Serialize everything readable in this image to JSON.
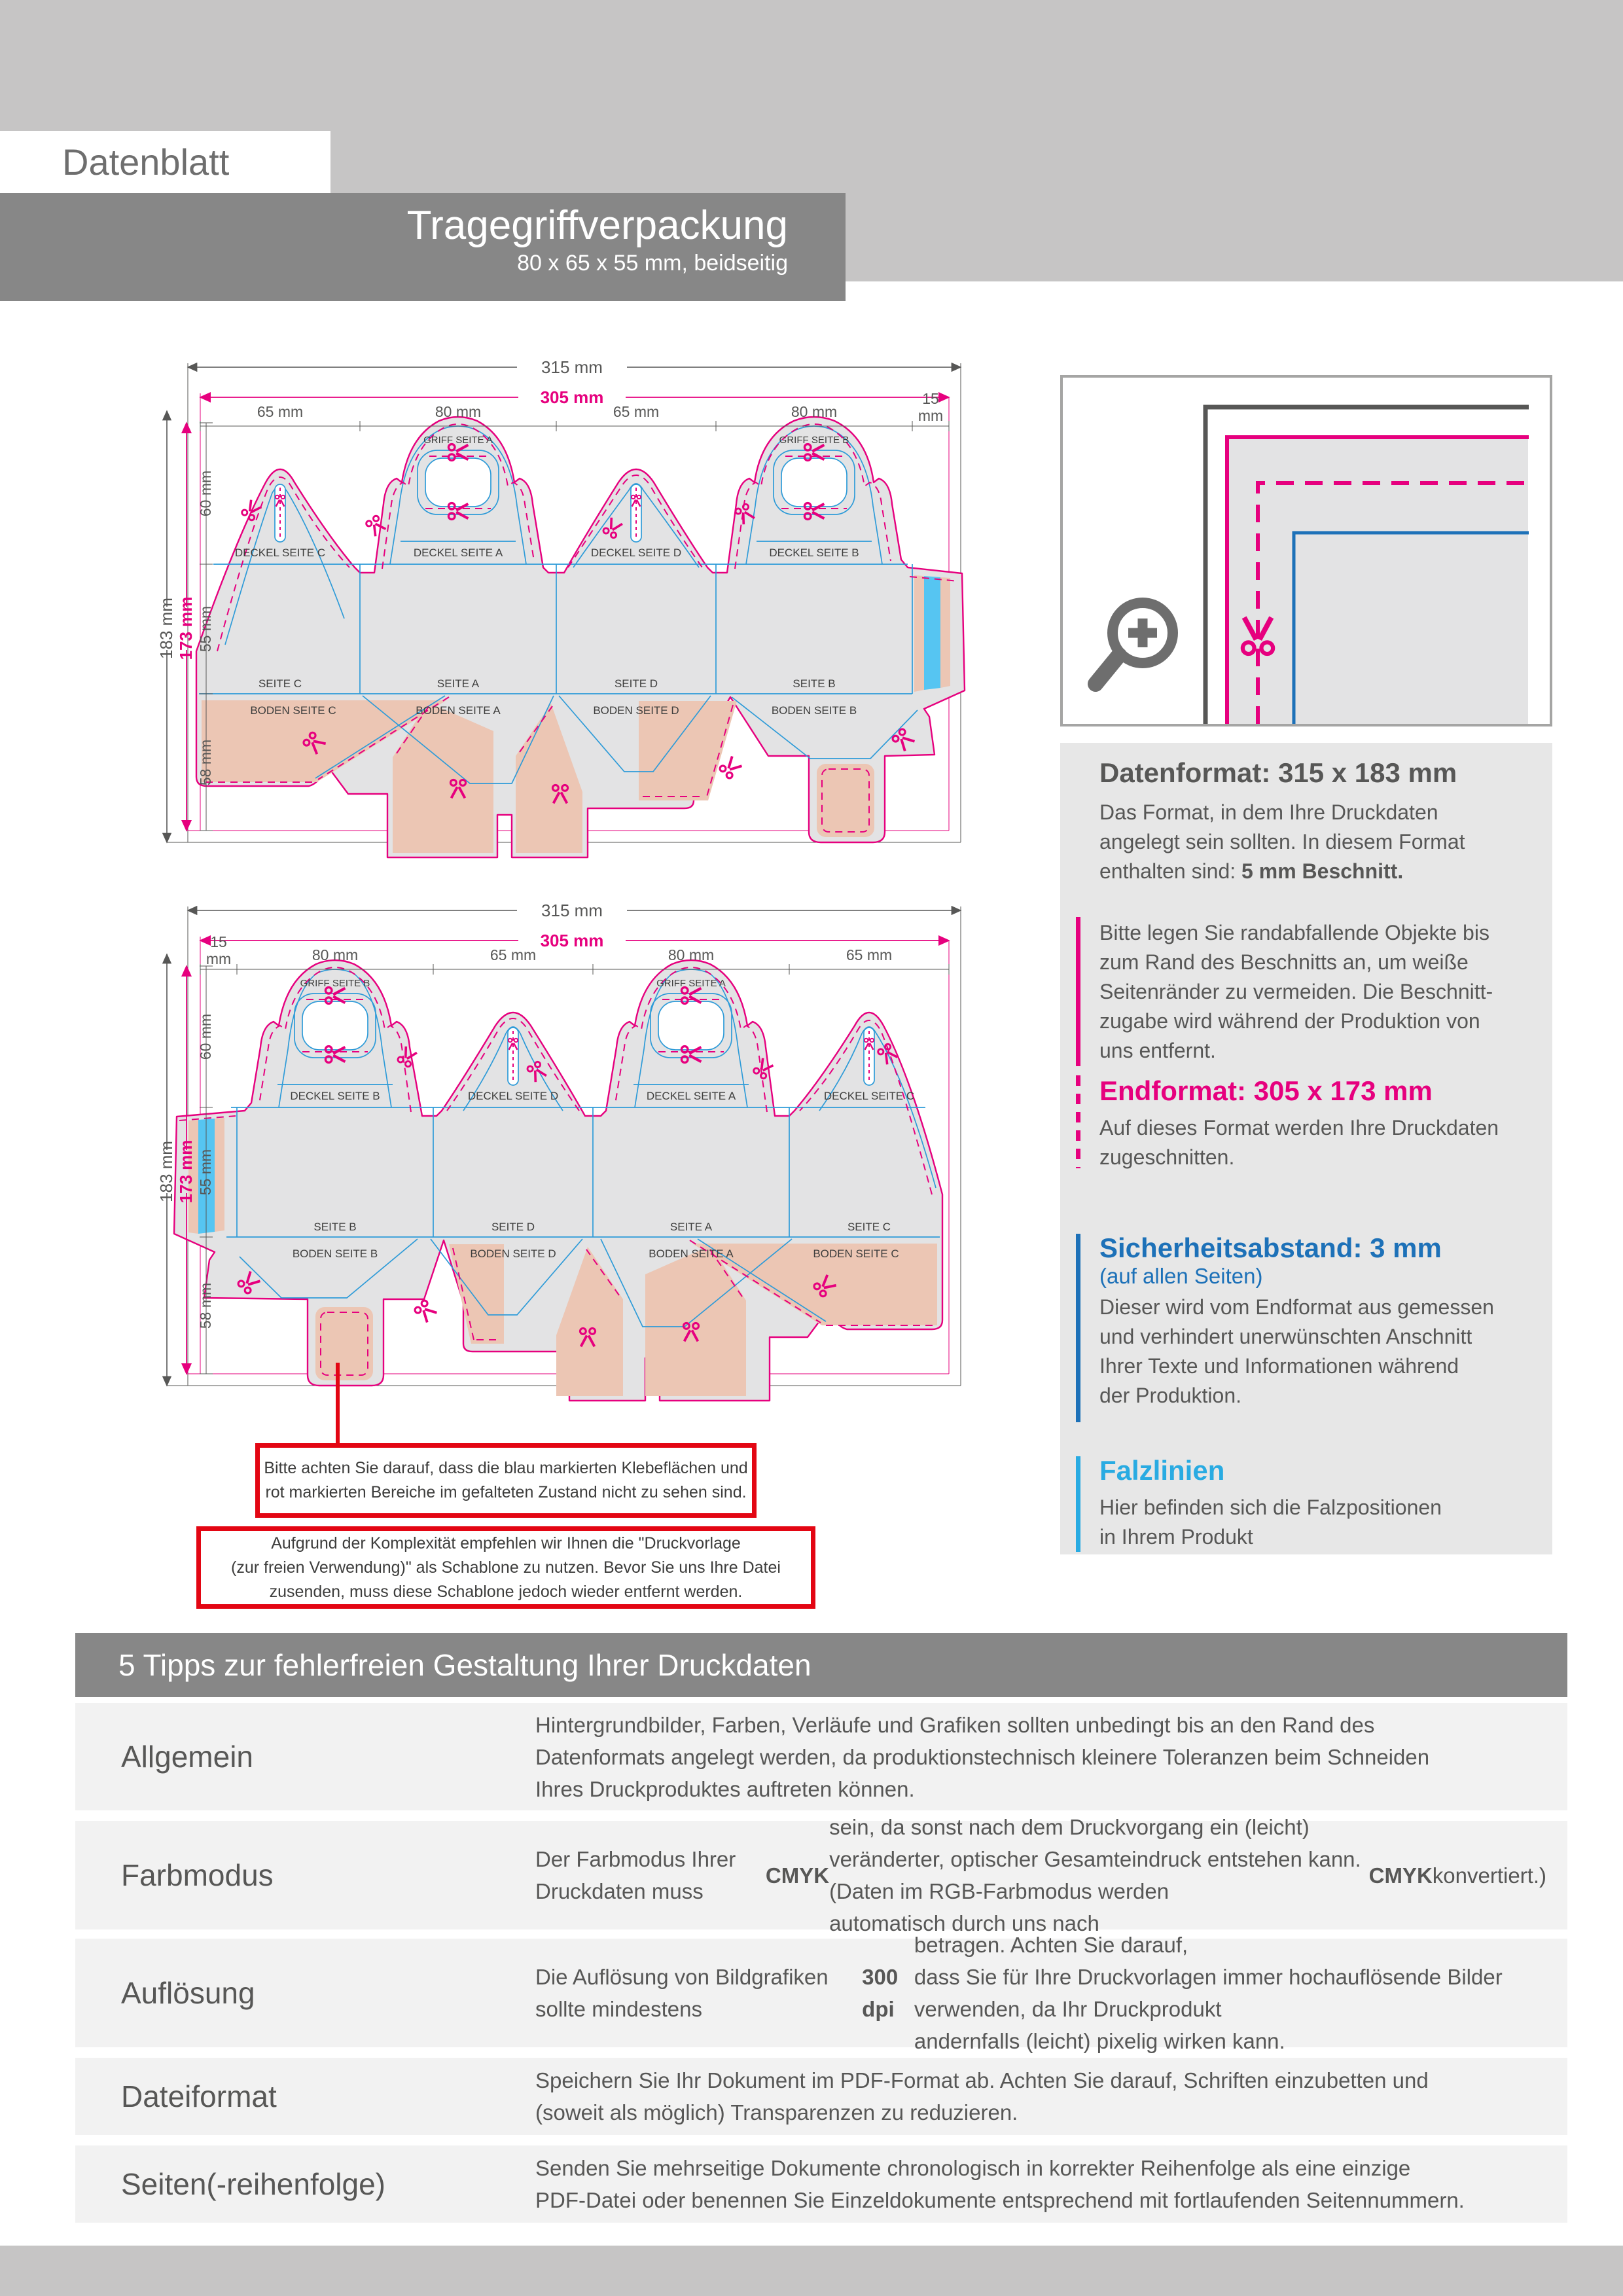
{
  "header": {
    "sheet_label": "Datenblatt",
    "product_title": "Tragegriffverpackung",
    "product_subtitle": "80 x 65 x 55 mm, beidseitig"
  },
  "legend": {
    "datenformat_title": "Datenformat: 315 x 183 mm",
    "datenformat_body": [
      {
        "t": "Das Format, in dem Ihre Druckdaten\nangelegt sein sollten. In diesem Format\nenthalten sind: "
      },
      {
        "t": "5 mm Beschnitt.",
        "b": true
      }
    ],
    "bleed_note": "Bitte legen Sie randabfallende Objekte bis\nzum Rand des Beschnitts an, um weiße\nSeitenränder zu vermeiden. Die Beschnitt-\nzugabe wird während der Produktion von\nuns entfernt.",
    "endformat_title": "Endformat: 305 x 173 mm",
    "endformat_body": "Auf dieses Format werden Ihre Druckdaten\nzugeschnitten.",
    "sicherheitsabstand_title": "Sicherheitsabstand: 3 mm",
    "sicherheitsabstand_sub": "(auf allen Seiten)",
    "sicherheitsabstand_body": "Dieser wird vom Endformat aus gemessen\nund verhindert unerwünschten Anschnitt\nIhrer Texte und Informationen während\nder Produktion.",
    "falzlinien_title": "Falzlinien",
    "falzlinien_body": "Hier befinden sich die Falzpositionen\nin Ihrem Produkt"
  },
  "diagram1": {
    "total_width": "315 mm",
    "trim_width": "305 mm",
    "seg_1": "65 mm",
    "seg_2": "80 mm",
    "seg_3": "65 mm",
    "seg_4": "80 mm",
    "seg_5a": "15",
    "seg_5b": "mm",
    "total_height": "183 mm",
    "trim_height": "173 mm",
    "sec_top": "60 mm",
    "sec_mid": "55 mm",
    "sec_bot": "58 mm",
    "griff_a": "GRIFF SEITE A",
    "griff_b": "GRIFF SEITE B",
    "deckel_1": "DECKEL SEITE C",
    "deckel_2": "DECKEL SEITE A",
    "deckel_3": "DECKEL SEITE D",
    "deckel_4": "DECKEL SEITE B",
    "seite_1": "SEITE C",
    "seite_2": "SEITE A",
    "seite_3": "SEITE D",
    "seite_4": "SEITE B",
    "boden_1": "BODEN SEITE C",
    "boden_2": "BODEN SEITE A",
    "boden_3": "BODEN SEITE D",
    "boden_4": "BODEN SEITE B"
  },
  "diagram2": {
    "total_width": "315 mm",
    "trim_width": "305 mm",
    "seg_1a": "15",
    "seg_1b": "mm",
    "seg_2": "80 mm",
    "seg_3": "65 mm",
    "seg_4": "80 mm",
    "seg_5": "65 mm",
    "total_height": "183 mm",
    "trim_height": "173 mm",
    "sec_top": "60 mm",
    "sec_mid": "55 mm",
    "sec_bot": "58 mm",
    "griff_b": "GRIFF SEITE B",
    "griff_a": "GRIFF SEITE A",
    "deckel_1": "DECKEL SEITE B",
    "deckel_2": "DECKEL SEITE D",
    "deckel_3": "DECKEL SEITE A",
    "deckel_4": "DECKEL SEITE C",
    "seite_1": "SEITE B",
    "seite_2": "SEITE D",
    "seite_3": "SEITE A",
    "seite_4": "SEITE C",
    "boden_1": "BODEN SEITE B",
    "boden_2": "BODEN SEITE D",
    "boden_3": "BODEN SEITE A",
    "boden_4": "BODEN SEITE C"
  },
  "notes": {
    "note1": "Bitte achten Sie darauf, dass die blau markierten Klebeflächen und\nrot markierten Bereiche im gefalteten Zustand nicht zu sehen sind.",
    "note2": "Aufgrund der Komplexität empfehlen wir Ihnen die \"Druckvorlage\n(zur freien Verwendung)\" als Schablone zu nutzen. Bevor Sie uns Ihre Datei\nzusenden, muss diese Schablone jedoch wieder entfernt werden."
  },
  "tips": {
    "heading": "5 Tipps zur fehlerfreien Gestaltung Ihrer Druckdaten",
    "rows": [
      {
        "label": "Allgemein",
        "text": [
          {
            "t": "Hintergrundbilder, Farben, Verläufe und Grafiken sollten unbedingt bis an den Rand des\nDatenformats angelegt werden, da produktionstechnisch kleinere Toleranzen beim Schneiden\nIhres Druckproduktes auftreten können."
          }
        ]
      },
      {
        "label": "Farbmodus",
        "text": [
          {
            "t": "Der Farbmodus Ihrer Druckdaten muss "
          },
          {
            "t": "CMYK",
            "b": true
          },
          {
            "t": " sein, da sonst nach dem Druckvorgang ein (leicht)\nveränderter, optischer Gesamteindruck entstehen kann. (Daten im RGB-Farbmodus werden\nautomatisch durch uns nach "
          },
          {
            "t": "CMYK",
            "b": true
          },
          {
            "t": " konvertiert.)"
          }
        ]
      },
      {
        "label": "Auflösung",
        "text": [
          {
            "t": "Die Auflösung von Bildgrafiken sollte mindestens "
          },
          {
            "t": "300 dpi",
            "b": true
          },
          {
            "t": " betragen. Achten Sie darauf,\ndass Sie für Ihre Druckvorlagen immer hochauflösende Bilder verwenden, da Ihr Druckprodukt\nandernfalls (leicht) pixelig wirken kann."
          }
        ]
      },
      {
        "label": "Dateiformat",
        "text": [
          {
            "t": "Speichern Sie Ihr Dokument im PDF-Format ab. Achten Sie darauf, Schriften einzubetten und\n(soweit als möglich) Transparenzen zu reduzieren."
          }
        ]
      },
      {
        "label": "Seiten(-reihenfolge)",
        "text": [
          {
            "t": "Senden Sie mehrseitige Dokumente chronologisch in korrekter Reihenfolge als eine einzige\nPDF-Datei oder benennen Sie Einzeldokumente entsprechend mit fortlaufenden Seitennummern."
          }
        ]
      }
    ]
  },
  "colors": {
    "magenta_cut": "#e6007e",
    "blue_safety": "#1d71b8",
    "cyan_fold": "#29abe2",
    "cyan_glue": "#56c5f2",
    "salmon_glue": "#ecc6b4",
    "red_warning": "#e30613",
    "banner_gray": "#878787",
    "die_gray": "#e3e3e4"
  }
}
